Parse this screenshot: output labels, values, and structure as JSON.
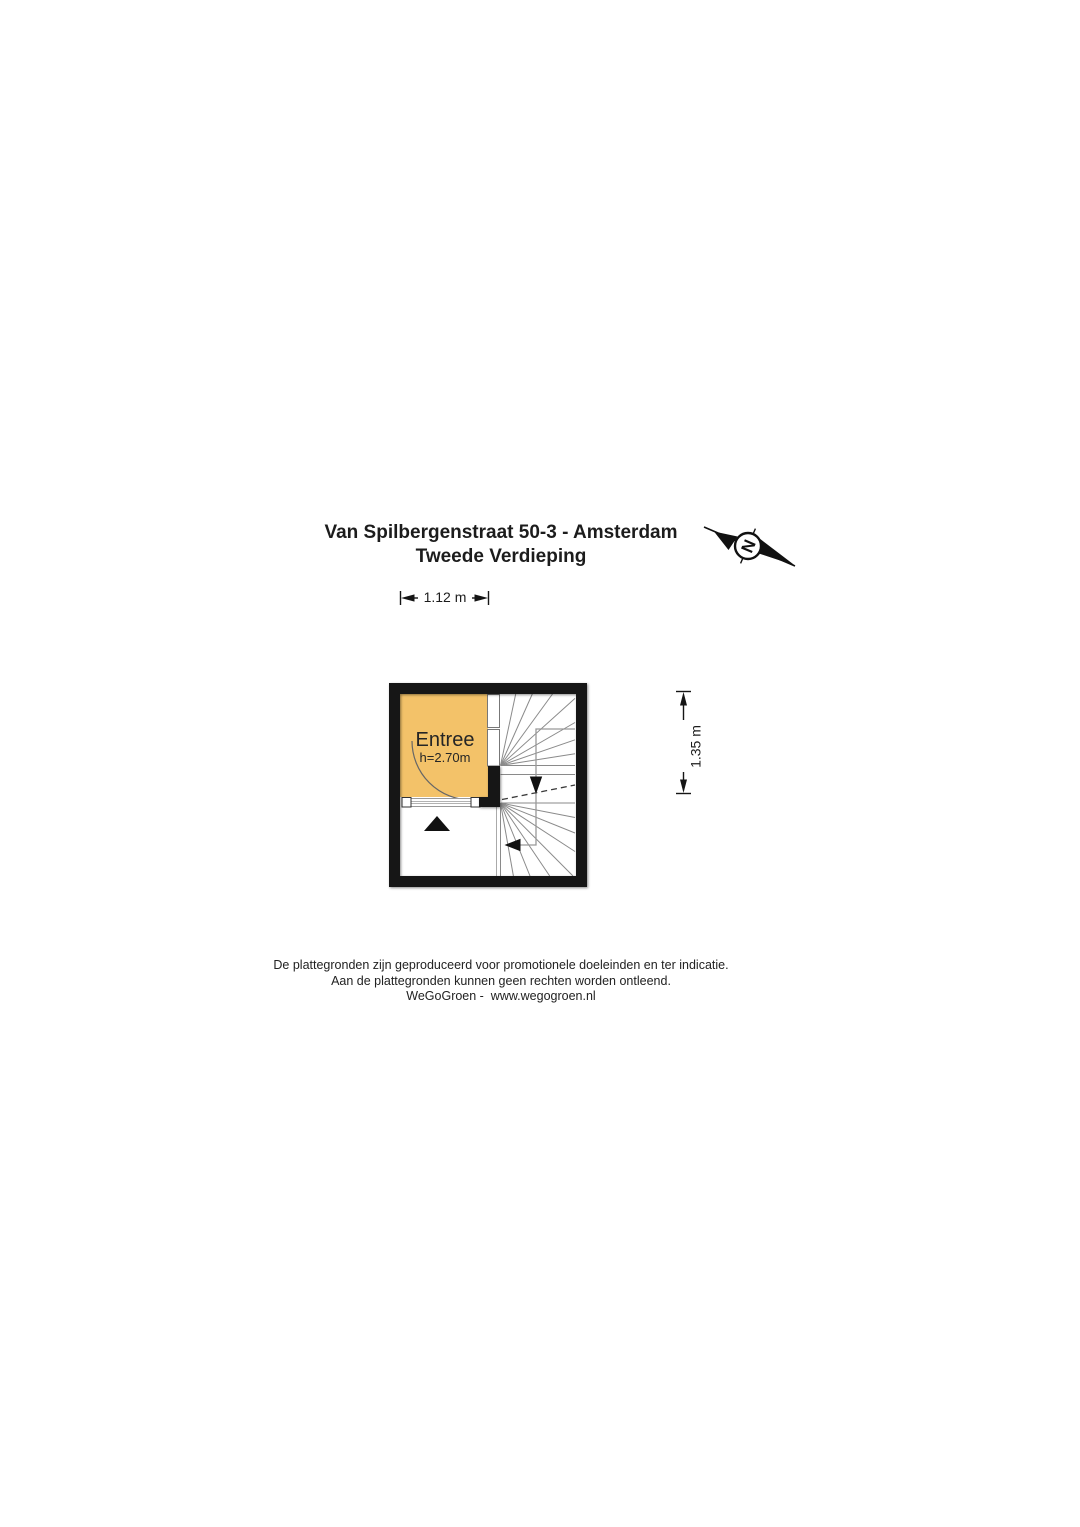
{
  "title": {
    "line1": "Van Spilbergenstraat 50-3 - Amsterdam",
    "line2": "Tweede Verdieping"
  },
  "compass": {
    "north_label": "N"
  },
  "dimensions": {
    "width_label": "1.12 m",
    "height_label": "1.35 m"
  },
  "floorplan": {
    "room": {
      "name": "Entree",
      "ceiling_height_label": "h=2.70m",
      "fill_color": "#f3c269"
    },
    "colors": {
      "wall": "#141414",
      "stair_line": "#8a8a8a",
      "walk_line": "#999999",
      "dash_line": "#3a3a3a"
    }
  },
  "footer": {
    "line1": "De plattegronden zijn geproduceerd voor promotionele doeleinden en ter indicatie.",
    "line2": "Aan de plattegronden kunnen geen rechten worden ontleend.",
    "line3": "WeGoGroen -  www.wegogroen.nl"
  }
}
